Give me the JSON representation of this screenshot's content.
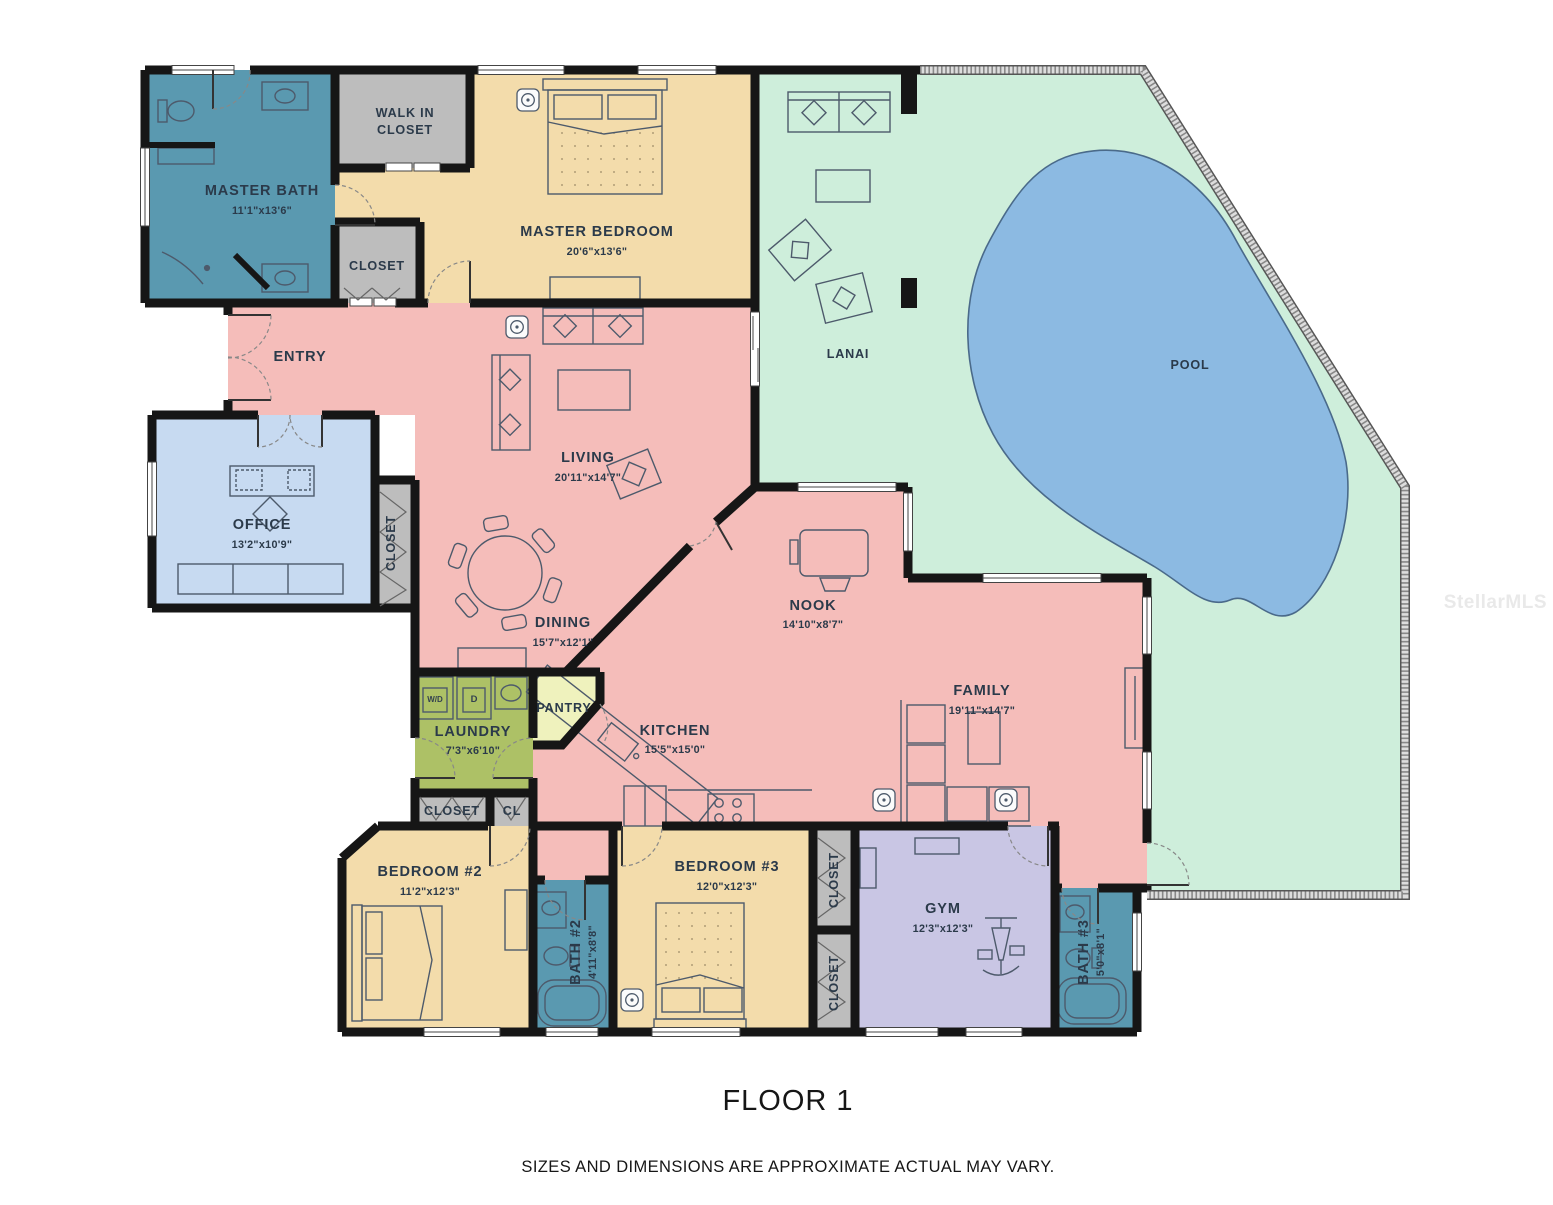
{
  "title": "FLOOR 1",
  "disclaimer": "SIZES AND DIMENSIONS ARE APPROXIMATE ACTUAL MAY VARY.",
  "watermark": "StellarMLS",
  "colors": {
    "bath": "#5a99b0",
    "bedroom": "#f3dcab",
    "living": "#f5bdba",
    "office": "#c7daf1",
    "lanai": "#ceeedb",
    "pool": "#8cbae2",
    "closet": "#bdbdbd",
    "laundry": "#adc166",
    "pantry": "#eff2bd",
    "gym": "#c9c6e4",
    "wall": "#161616",
    "label": "#2b3a4a",
    "watermark_color": "#e9e9e9"
  },
  "rooms": {
    "master_bath": {
      "name": "MASTER BATH",
      "dims": "11'1\"x13'6\""
    },
    "walk_in_closet": {
      "line1": "WALK IN",
      "line2": "CLOSET"
    },
    "entry_closet": {
      "name": "CLOSET"
    },
    "master_bedroom": {
      "name": "MASTER BEDROOM",
      "dims": "20'6\"x13'6\""
    },
    "entry": {
      "name": "ENTRY"
    },
    "office": {
      "name": "OFFICE",
      "dims": "13'2\"x10'9\""
    },
    "office_closet": {
      "name": "CLOSET"
    },
    "living": {
      "name": "LIVING",
      "dims": "20'11\"x14'7\""
    },
    "dining": {
      "name": "DINING",
      "dims": "15'7\"x12'1\""
    },
    "nook": {
      "name": "NOOK",
      "dims": "14'10\"x8'7\""
    },
    "family": {
      "name": "FAMILY",
      "dims": "19'11\"x14'7\""
    },
    "kitchen": {
      "name": "KITCHEN",
      "dims": "15'5\"x15'0\""
    },
    "pantry": {
      "name": "PANTRY"
    },
    "laundry": {
      "name": "LAUNDRY",
      "dims": "7'3\"x6'10\""
    },
    "hall_closet": {
      "name": "CLOSET"
    },
    "hall_cl": {
      "name": "CL"
    },
    "bedroom2": {
      "name": "BEDROOM #2",
      "dims": "11'2\"x12'3\""
    },
    "bath2": {
      "name": "BATH #2",
      "dims": "4'11\"x8'8\""
    },
    "bedroom3": {
      "name": "BEDROOM #3",
      "dims": "12'0\"x12'3\""
    },
    "closet3_upper": {
      "name": "CLOSET"
    },
    "closet3_lower": {
      "name": "CLOSET"
    },
    "gym": {
      "name": "GYM",
      "dims": "12'3\"x12'3\""
    },
    "bath3": {
      "name": "BATH #3",
      "dims": "5'0\"x8'1\""
    },
    "lanai": {
      "name": "LANAI"
    },
    "pool": {
      "name": "POOL"
    }
  },
  "appliances": {
    "washer_dryer": "W/D",
    "dryer": "D"
  }
}
